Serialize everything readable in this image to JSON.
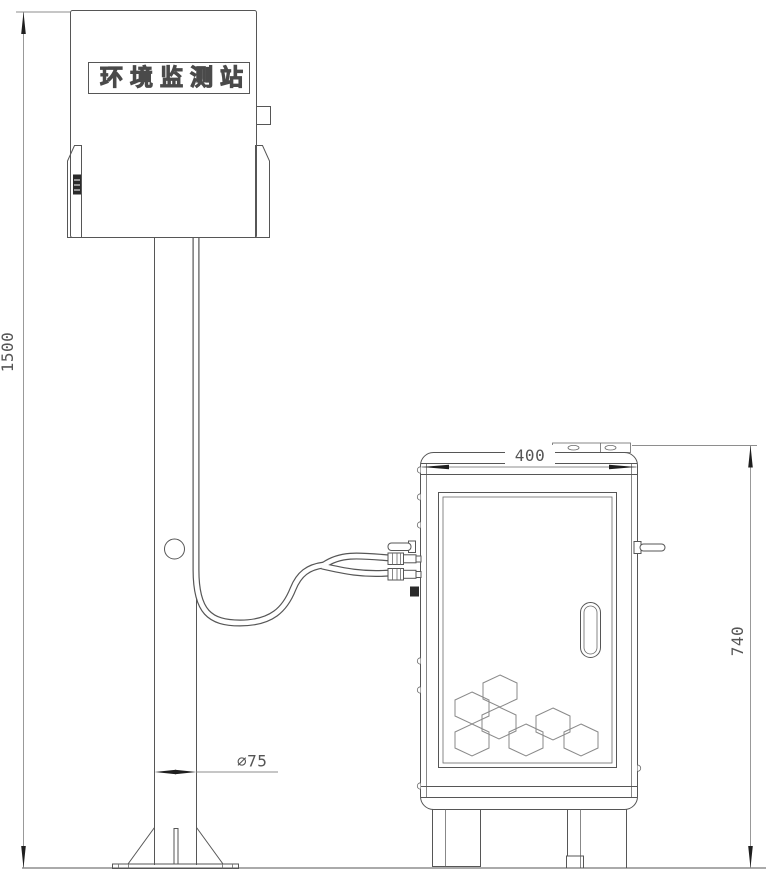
{
  "drawing": {
    "station_label": "环境监测站",
    "dimensions": {
      "pole_height": "1500",
      "cabinet_width": "400",
      "cabinet_height": "740",
      "pole_diameter": "∅75"
    },
    "colors": {
      "line": "#565656",
      "dimension_line": "#8e8e8e",
      "arrow": "#1f1f1f",
      "text": "#555555",
      "background": "#ffffff"
    }
  }
}
